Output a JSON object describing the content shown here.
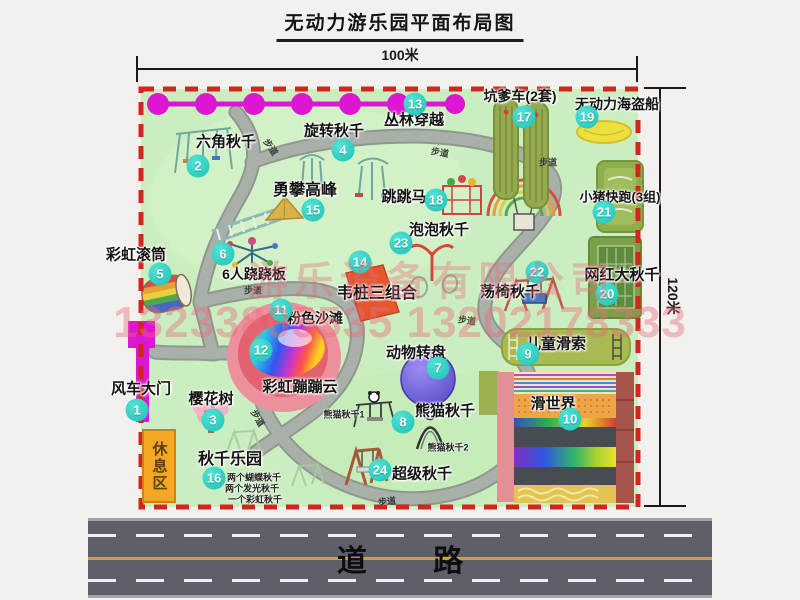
{
  "title": {
    "text": "无动力游乐园平面布局图"
  },
  "dimensions": {
    "width_label": "100米",
    "height_label": "120米"
  },
  "road": {
    "label": "道 路"
  },
  "watermark": {
    "company": "游乐设备有限公司",
    "phone": "13233805535 13202178333"
  },
  "palette": {
    "map_green": "#cbeec0",
    "border_red": "#d0261f",
    "magenta": "#dd16d2",
    "path_gray": "#a9b0a9",
    "bubble_teal": "#1ec2b6",
    "road_gray": "#5f5f6a",
    "rest_area_orange": "#f5a623"
  },
  "map": {
    "footpath_label": "步道",
    "rest_area": {
      "label": "休息区"
    },
    "attractions": [
      {
        "num": 1,
        "key": "windmill-gate",
        "label": "风车大门",
        "lx": 141,
        "ly": 388,
        "bx": 137,
        "by": 410
      },
      {
        "num": 2,
        "key": "hexagon-swing",
        "label": "六角秋千",
        "lx": 226,
        "ly": 141,
        "bx": 198,
        "by": 166
      },
      {
        "num": 3,
        "key": "cherry-tree",
        "label": "樱花树",
        "lx": 211,
        "ly": 398,
        "bx": 213,
        "by": 420
      },
      {
        "num": 4,
        "key": "rotating-swing",
        "label": "旋转秋千",
        "lx": 334,
        "ly": 130,
        "bx": 343,
        "by": 150
      },
      {
        "num": 5,
        "key": "rainbow-roller",
        "label": "彩虹滚筒",
        "lx": 136,
        "ly": 254,
        "bx": 160,
        "by": 274
      },
      {
        "num": 6,
        "key": "six-person-seesaw",
        "label": "6人跷跷板",
        "lx": 254,
        "ly": 274,
        "bx": 223,
        "by": 254,
        "fs": 14
      },
      {
        "num": 7,
        "key": "animal-turntable",
        "label": "动物转盘",
        "lx": 416,
        "ly": 352,
        "bx": 438,
        "by": 368
      },
      {
        "num": 8,
        "key": "panda-swing",
        "label": "熊猫秋千",
        "lx": 445,
        "ly": 410,
        "bx": 403,
        "by": 422
      },
      {
        "num": 9,
        "key": "kids-zipline",
        "label": "儿童滑索",
        "lx": 556,
        "ly": 343,
        "bx": 528,
        "by": 354
      },
      {
        "num": 10,
        "key": "slide-world",
        "label": "滑世界",
        "lx": 553,
        "ly": 403,
        "bx": 570,
        "by": 419
      },
      {
        "num": 11,
        "key": "pink-beach",
        "label": "粉色沙滩",
        "lx": 315,
        "ly": 318,
        "bx": 281,
        "by": 310,
        "fs": 14
      },
      {
        "num": 12,
        "key": "rainbow-bounce-cloud",
        "label": "彩虹蹦蹦云",
        "lx": 300,
        "ly": 386,
        "bx": 261,
        "by": 350
      },
      {
        "num": 13,
        "key": "jungle-crossing",
        "label": "丛林穿越",
        "lx": 414,
        "ly": 119,
        "bx": 415,
        "by": 104
      },
      {
        "num": 14,
        "key": "pile-combo",
        "label": "韦桩三组合",
        "lx": 377,
        "ly": 291,
        "bx": 360,
        "by": 262,
        "fs": 16
      },
      {
        "num": 15,
        "key": "peak-climbing",
        "label": "勇攀高峰",
        "lx": 305,
        "ly": 188,
        "bx": 313,
        "by": 210,
        "fs": 16
      },
      {
        "num": 16,
        "key": "swing-park",
        "label": "秋千乐园",
        "lx": 230,
        "ly": 457,
        "bx": 214,
        "by": 478,
        "fs": 16
      },
      {
        "num": 17,
        "key": "kengdie-car",
        "label": "坑爹车(2套)",
        "lx": 520,
        "ly": 96,
        "bx": 524,
        "by": 117,
        "fs": 14
      },
      {
        "num": 18,
        "key": "jumping-horse",
        "label": "跳跳马",
        "lx": 404,
        "ly": 196,
        "bx": 436,
        "by": 200
      },
      {
        "num": 19,
        "key": "pirate-ship",
        "label": "无动力海盗船",
        "lx": 617,
        "ly": 104,
        "bx": 587,
        "by": 117,
        "fs": 14
      },
      {
        "num": 20,
        "key": "big-swing",
        "label": "网红大秋千",
        "lx": 622,
        "ly": 274,
        "bx": 607,
        "by": 294
      },
      {
        "num": 21,
        "key": "piggy-run",
        "label": "小猪快跑(3组)",
        "lx": 620,
        "ly": 196,
        "bx": 604,
        "by": 212,
        "fs": 13
      },
      {
        "num": 22,
        "key": "chair-swing",
        "label": "荡椅秋千",
        "lx": 510,
        "ly": 291,
        "bx": 537,
        "by": 272
      },
      {
        "num": 23,
        "key": "bubble-swing",
        "label": "泡泡秋千",
        "lx": 439,
        "ly": 229,
        "bx": 401,
        "by": 243
      },
      {
        "num": 24,
        "key": "super-swing",
        "label": "超级秋千",
        "lx": 422,
        "ly": 473,
        "bx": 380,
        "by": 470
      }
    ],
    "path_labels": [
      {
        "x": 271,
        "y": 147,
        "rot": 55
      },
      {
        "x": 440,
        "y": 152,
        "rot": 10
      },
      {
        "x": 548,
        "y": 162,
        "rot": 0
      },
      {
        "x": 253,
        "y": 290,
        "rot": 0
      },
      {
        "x": 467,
        "y": 320,
        "rot": 8
      },
      {
        "x": 258,
        "y": 418,
        "rot": 60
      },
      {
        "x": 387,
        "y": 501,
        "rot": -5
      }
    ],
    "sub_labels": [
      {
        "key": "panda-swing-1",
        "text": "熊猫秋千1",
        "x": 344,
        "y": 414
      },
      {
        "key": "panda-swing-2",
        "text": "熊猫秋千2",
        "x": 448,
        "y": 447
      },
      {
        "key": "swing-note-1",
        "text": "两个蝴蝶秋千",
        "x": 254,
        "y": 477
      },
      {
        "key": "swing-note-2",
        "text": "两个发光秋千",
        "x": 252,
        "y": 488
      },
      {
        "key": "swing-note-3",
        "text": "一个彩虹秋千",
        "x": 255,
        "y": 499
      }
    ]
  }
}
